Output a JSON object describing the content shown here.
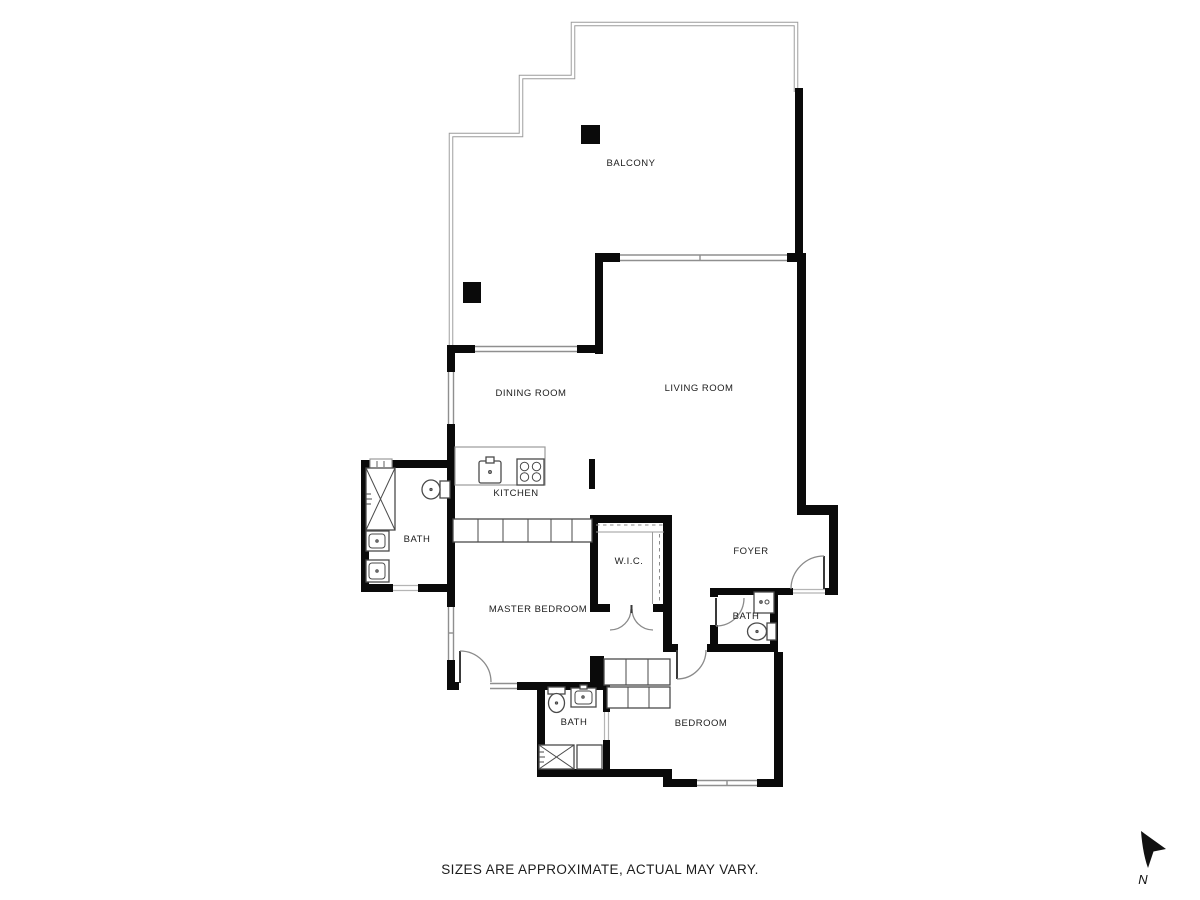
{
  "rooms": {
    "balcony": {
      "label": "BALCONY"
    },
    "dining_room": {
      "label": "DINING ROOM"
    },
    "living_room": {
      "label": "LIVING ROOM"
    },
    "kitchen": {
      "label": "KITCHEN"
    },
    "master_bath": {
      "label": "BATH"
    },
    "wic": {
      "label": "W.I.C."
    },
    "foyer": {
      "label": "FOYER"
    },
    "master_bedroom": {
      "label": "MASTER BEDROOM"
    },
    "guest_bath": {
      "label": "BATH"
    },
    "second_bath": {
      "label": "BATH"
    },
    "bedroom": {
      "label": "BEDROOM"
    }
  },
  "footer": {
    "disclaimer": "SIZES ARE APPROXIMATE, ACTUAL MAY VARY."
  },
  "compass": {
    "label": "N"
  },
  "colors": {
    "wall": "#0a0a0a",
    "window": "#8f8f8f",
    "balcony_outline": "#9a9a9a",
    "fixture": "#4a4a4a",
    "background": "#ffffff"
  }
}
